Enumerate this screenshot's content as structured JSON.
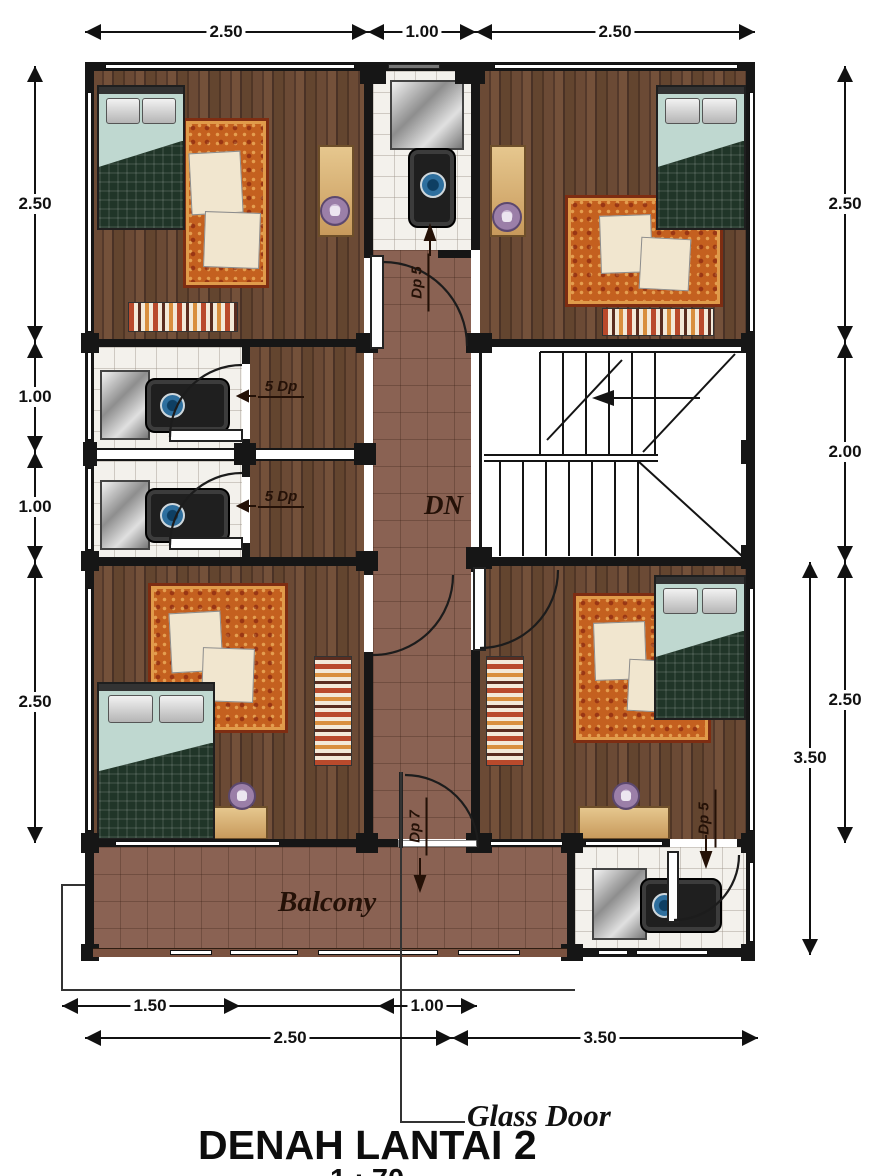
{
  "title": "DENAH LANTAI 2",
  "scale_note": "1 : 70",
  "labels": {
    "stairs_down": "DN",
    "balcony": "Balcony",
    "glass_door": "Glass Door"
  },
  "door_tags": {
    "top_bathroom": "Dp 5",
    "mid_bathroom_upper": "5 Dp",
    "mid_bathroom_lower": "5 Dp",
    "balcony_door": "Dp 7",
    "bottom_bathroom": "Dp 5"
  },
  "dims": {
    "top": [
      "2.50",
      "1.00",
      "2.50"
    ],
    "left": [
      "2.50",
      "1.00",
      "1.00",
      "2.50"
    ],
    "right": [
      "2.50",
      "2.00",
      "2.50"
    ],
    "right_outer": "3.50",
    "bottom_upper": [
      "1.50",
      "1.00"
    ],
    "bottom_lower": [
      "2.50",
      "3.50"
    ]
  },
  "colors": {
    "wall": "#161616",
    "wood_floor": "#5c4130",
    "corridor_tile": "#8a6253",
    "bath_tile": "#f3f1ec",
    "rug": "#c4601f",
    "blanket": "#203528",
    "bed_sheet": "#bfd8d0",
    "desk": "#d9b37a",
    "stool": "#9b7fa8",
    "basin_blue": "#2e6f9e"
  }
}
